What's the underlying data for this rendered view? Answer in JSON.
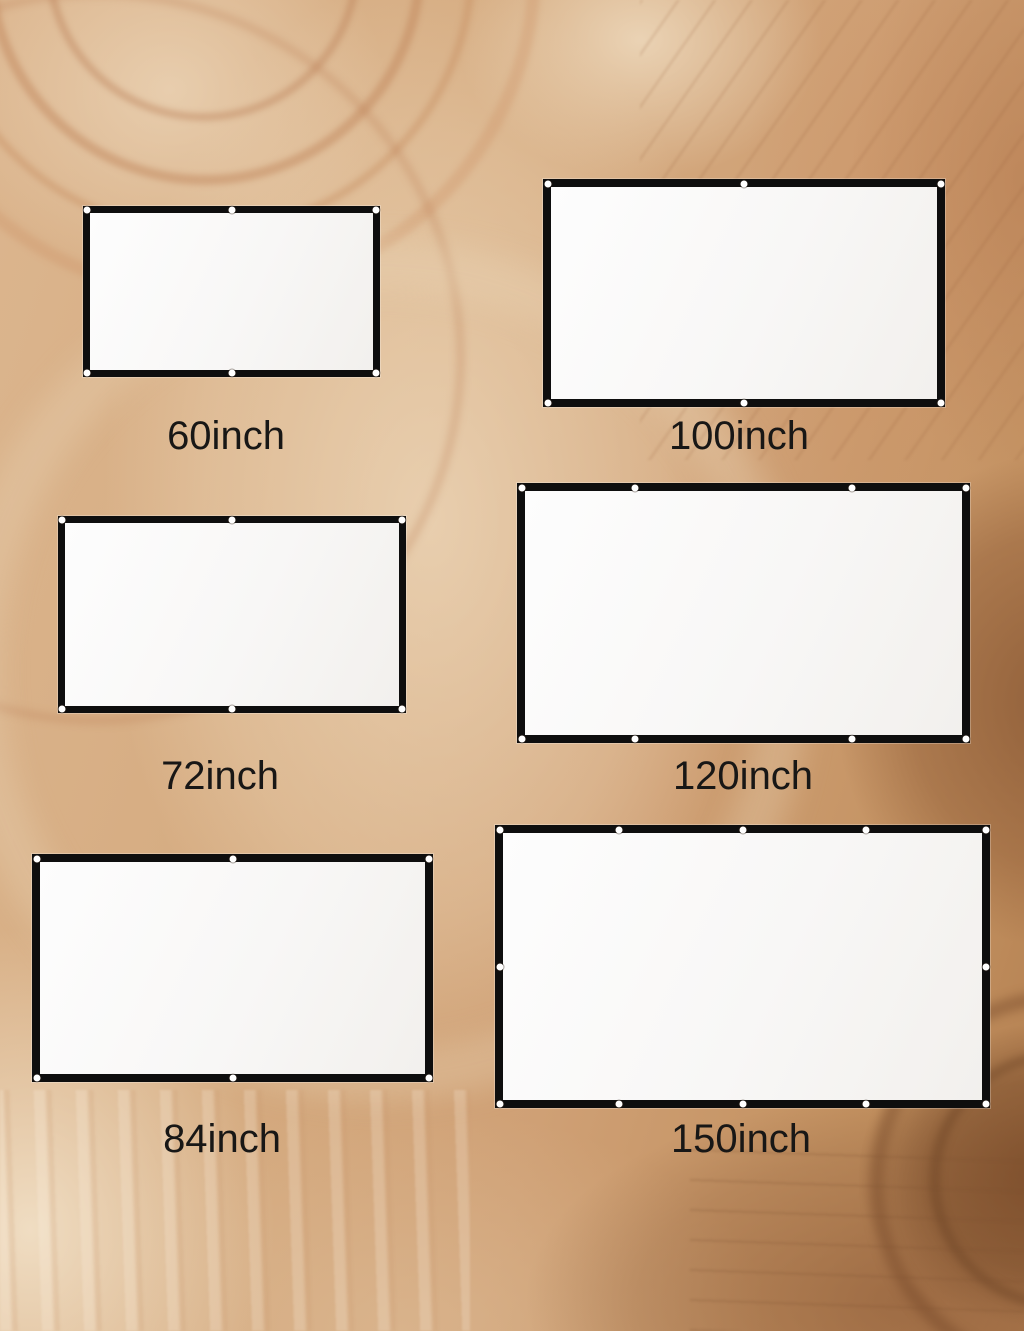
{
  "background": {
    "style": "wood-grain swirl photo",
    "colors": {
      "wood_base": "#d2a67c",
      "wood_light_cream": "#eedcc2",
      "wood_rosy_tan": "#c79271",
      "wood_dark_band": "#96633c",
      "wood_knot": "#7b4e2c"
    }
  },
  "product": {
    "item": "projection screen size comparison",
    "screen_surface_color": "#f8f8f8",
    "screen_border_color": "#0e0e0e",
    "grommet_color": "#ffffff",
    "label_color": "#181716"
  },
  "screens": [
    {
      "label": "60inch",
      "geometry": {
        "x": 83,
        "y": 206,
        "w": 297,
        "h": 171,
        "border": 7,
        "label_cx": 226,
        "label_y": 416
      },
      "grommets": {
        "top": [
          0,
          0.5,
          1
        ],
        "bottom": [
          0,
          0.5,
          1
        ],
        "left": [],
        "right": []
      }
    },
    {
      "label": "100inch",
      "geometry": {
        "x": 543,
        "y": 179,
        "w": 402,
        "h": 228,
        "border": 8,
        "label_cx": 739,
        "label_y": 416
      },
      "grommets": {
        "top": [
          0,
          0.5,
          1
        ],
        "bottom": [
          0,
          0.5,
          1
        ],
        "left": [],
        "right": []
      }
    },
    {
      "label": "72inch",
      "geometry": {
        "x": 58,
        "y": 516,
        "w": 348,
        "h": 197,
        "border": 7,
        "label_cx": 220,
        "label_y": 756
      },
      "grommets": {
        "top": [
          0,
          0.5,
          1
        ],
        "bottom": [
          0,
          0.5,
          1
        ],
        "left": [],
        "right": []
      }
    },
    {
      "label": "120inch",
      "geometry": {
        "x": 517,
        "y": 483,
        "w": 453,
        "h": 260,
        "border": 8,
        "label_cx": 743,
        "label_y": 756
      },
      "grommets": {
        "top": [
          0,
          0.26,
          0.74,
          1
        ],
        "bottom": [
          0,
          0.26,
          0.74,
          1
        ],
        "left": [],
        "right": []
      }
    },
    {
      "label": "84inch",
      "geometry": {
        "x": 32,
        "y": 854,
        "w": 401,
        "h": 228,
        "border": 8,
        "label_cx": 222,
        "label_y": 1119
      },
      "grommets": {
        "top": [
          0,
          0.5,
          1
        ],
        "bottom": [
          0,
          0.5,
          1
        ],
        "left": [],
        "right": []
      }
    },
    {
      "label": "150inch",
      "geometry": {
        "x": 495,
        "y": 825,
        "w": 495,
        "h": 283,
        "border": 8,
        "label_cx": 741,
        "label_y": 1119
      },
      "grommets": {
        "top": [
          0,
          0.25,
          0.5,
          0.75,
          1
        ],
        "bottom": [
          0,
          0.25,
          0.5,
          0.75,
          1
        ],
        "left": [
          0.5
        ],
        "right": [
          0.5
        ]
      }
    }
  ]
}
